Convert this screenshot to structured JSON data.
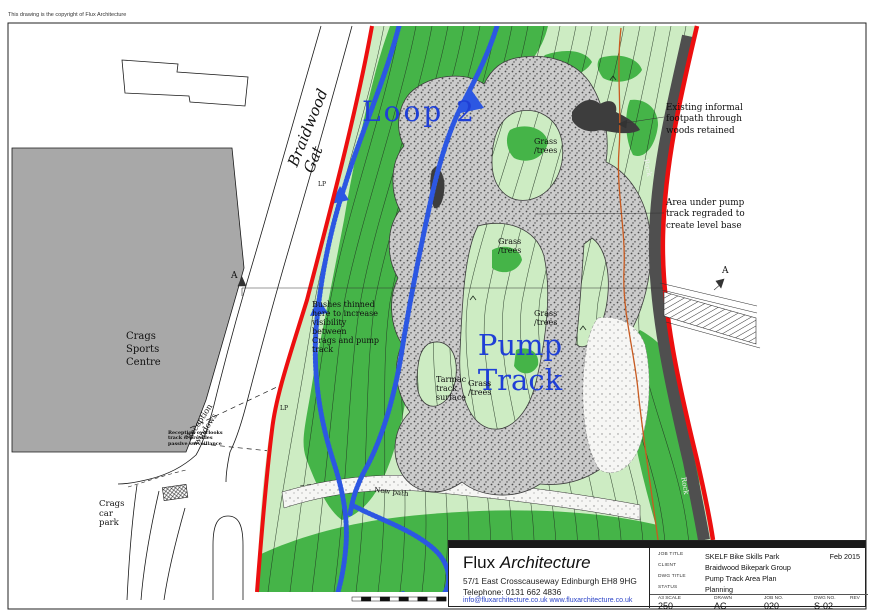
{
  "copyright": "This drawing is the copyright of Flux Architecture",
  "map_labels": {
    "road": "Braidwood Gat",
    "loop2": "Loop 2",
    "pump_track": "Pump\nTrack",
    "grass_trees": "Grass\n/trees",
    "tarmac": "Tarmac\ntrack\nsurface",
    "bushes": "Bushes thinned\nhere to increase\nvisibility between\nCrags and pump\ntrack",
    "crags_sports_centre": "Crags\nSports\nCentre",
    "crags_car_park": "Crags\ncar\npark",
    "reception_windows": "Reception windows",
    "reception_note": "Reception overlooks\ntrack & provides\npassive surveillance",
    "new_path": "New path",
    "rock": "Rock",
    "lp": "LP",
    "section_marker": "A"
  },
  "annotations": {
    "footpath_note": "Existing informal\nfootpath through\nwoods retained",
    "regrade_note": "Area under pump\ntrack regraded to\ncreate level base"
  },
  "title_block": {
    "firm_first": "Flux",
    "firm_second": "Architecture",
    "address": "57/1 East Crosscauseway Edinburgh  EH8 9HG",
    "phone": "Telephone: 0131 662 4836",
    "email_web": "info@fluxarchitecture.co.uk  www.fluxarchitecture.co.uk",
    "date": "Feb 2015",
    "rows": [
      {
        "label": "JOB TITLE",
        "value": "SKELF Bike Skills Park"
      },
      {
        "label": "CLIENT",
        "value": "Braidwood Bikepark Group"
      },
      {
        "label": "DWG TITLE",
        "value": "Pump Track Area Plan"
      },
      {
        "label": "STATUS",
        "value": "Planning"
      }
    ],
    "footer": [
      {
        "label": "A3 SCALE",
        "value": "250"
      },
      {
        "label": "DRAWN",
        "value": "AC"
      },
      {
        "label": "JOB NO.",
        "value": "020"
      },
      {
        "label": "DWG NO.",
        "value": "S-02"
      },
      {
        "label": "REV",
        "value": ""
      }
    ]
  },
  "colors": {
    "boundary_red": "#ec0f0f",
    "grass_dark": "#45b448",
    "grass_light": "#cdecc3",
    "path_blue": "#2c57e2",
    "label_blue": "#1f3fd6",
    "rock_grey": "#4f4f4f",
    "fence_orange": "#c85a20"
  }
}
